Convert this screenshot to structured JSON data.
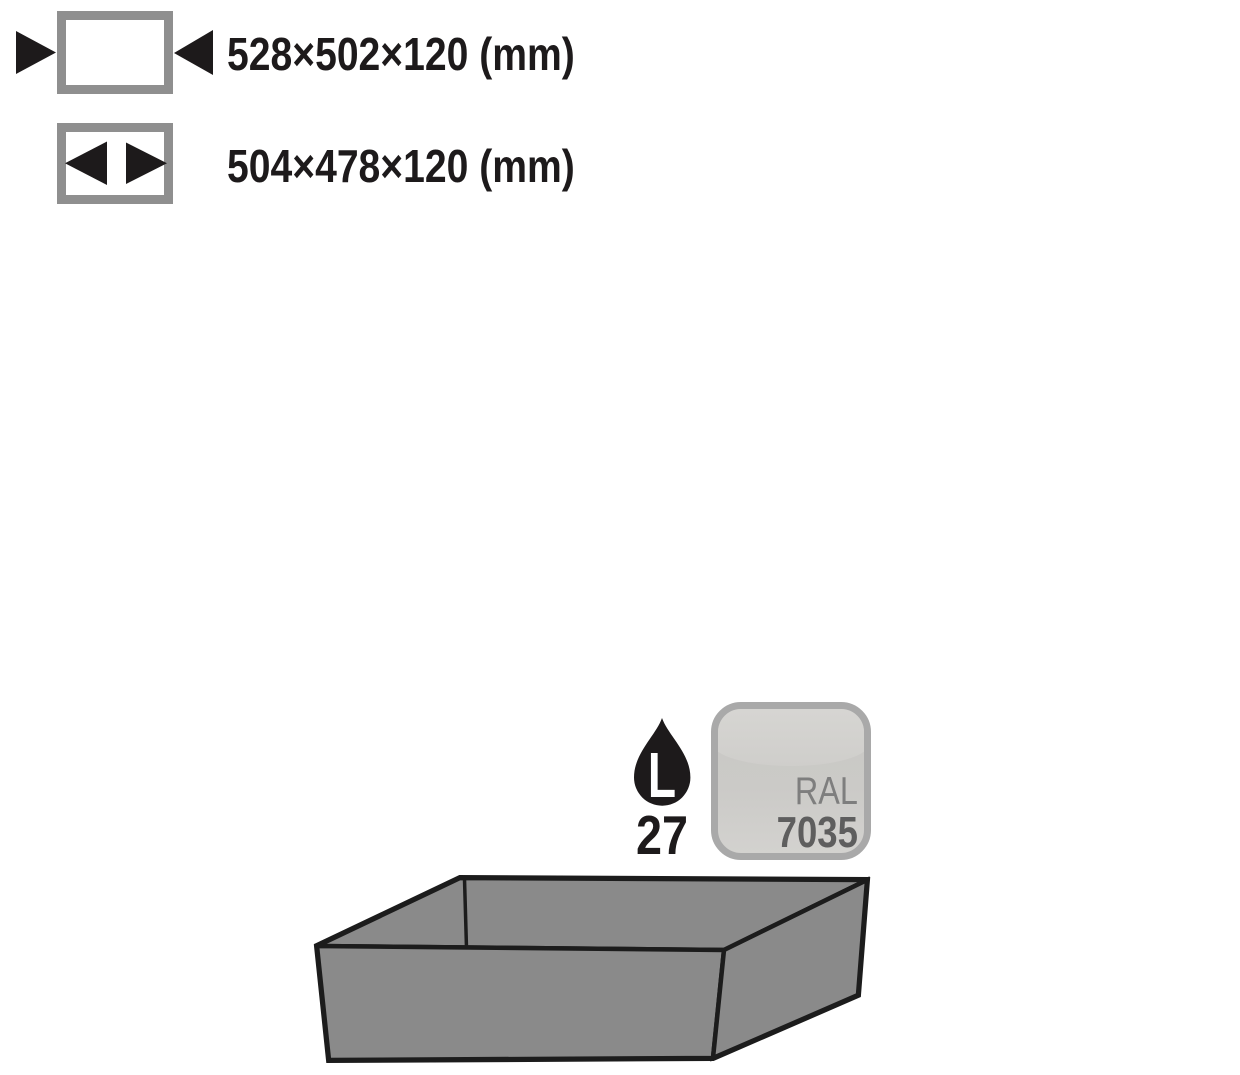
{
  "page": {
    "background_color": "#ffffff"
  },
  "specs": [
    {
      "icon": "external-dimensions-icon",
      "value": "528×502×120 (mm)"
    },
    {
      "icon": "internal-dimensions-icon",
      "value": "504×478×120 (mm)"
    }
  ],
  "capacity_badge": {
    "icon": "liquid-drop-icon",
    "drop_letter": "L",
    "value": "27",
    "drop_color": "#1d1a1b",
    "letter_color": "#ffffff"
  },
  "ral_badge": {
    "standard": "RAL",
    "code": "7035",
    "border_color": "#a9a9a9",
    "fill_top": "#d7d6d3",
    "fill_bottom": "#d3d2cf",
    "label_color": "#7e7e7e",
    "code_color": "#5e5e5e"
  },
  "illustration": {
    "name": "sump-tray",
    "fill": "#8a8a8a",
    "outline": "#1c1c1c"
  },
  "ui": {
    "text_color": "#1d1a1b",
    "arrow_color": "#1d1a1b",
    "icon_frame_color": "#8f8f8f"
  }
}
